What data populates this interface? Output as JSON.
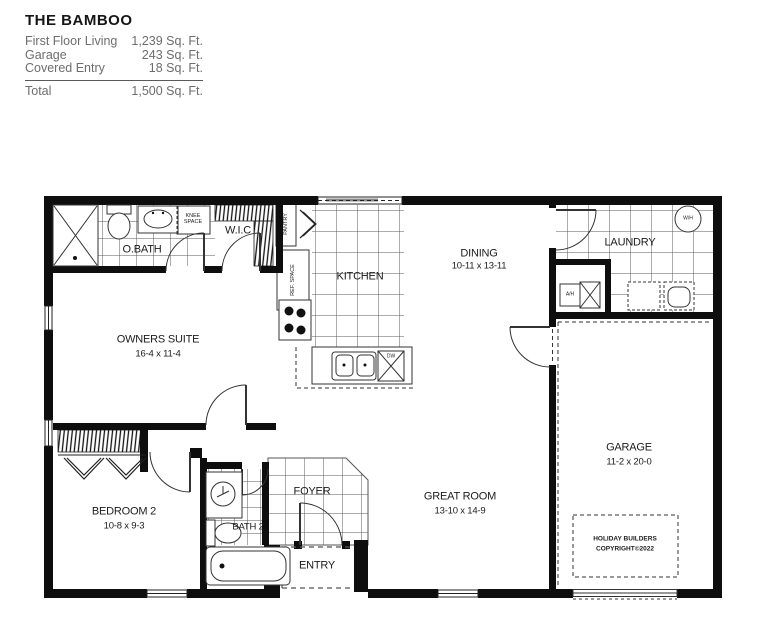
{
  "header": {
    "title": "THE BAMBOO",
    "rows": [
      {
        "label": "First Floor Living",
        "value": "1,239 Sq. Ft."
      },
      {
        "label": "Garage",
        "value": "243 Sq. Ft."
      },
      {
        "label": "Covered Entry",
        "value": "18 Sq. Ft."
      }
    ],
    "total": {
      "label": "Total",
      "value": "1,500 Sq. Ft."
    }
  },
  "plan": {
    "rooms": {
      "obath": "O.BATH",
      "knee_space": "KNEE\nSPACE",
      "wic": "W.I.C",
      "pantry": "PANTRY",
      "ref_space": "REF. SPACE",
      "kitchen": "KITCHEN",
      "dining": {
        "name": "DINING",
        "dims": "10-11 x 13-11"
      },
      "laundry": "LAUNDRY",
      "owners_suite": {
        "name": "OWNERS SUITE",
        "dims": "16-4 x 11-4"
      },
      "garage": {
        "name": "GARAGE",
        "dims": "11-2 x 20-0"
      },
      "bedroom2": {
        "name": "BEDROOM 2",
        "dims": "10-8 x 9-3"
      },
      "bath2": "BATH 2",
      "foyer": "FOYER",
      "entry": "ENTRY",
      "great_room": {
        "name": "GREAT ROOM",
        "dims": "13-10 x 14-9"
      }
    },
    "fixtures": {
      "water_heater": "W/H",
      "air_handler": "A/H",
      "dishwasher": "DW"
    },
    "copyright": {
      "line1": "HOLIDAY BUILDERS",
      "line2": "COPYRIGHT©2022"
    }
  }
}
